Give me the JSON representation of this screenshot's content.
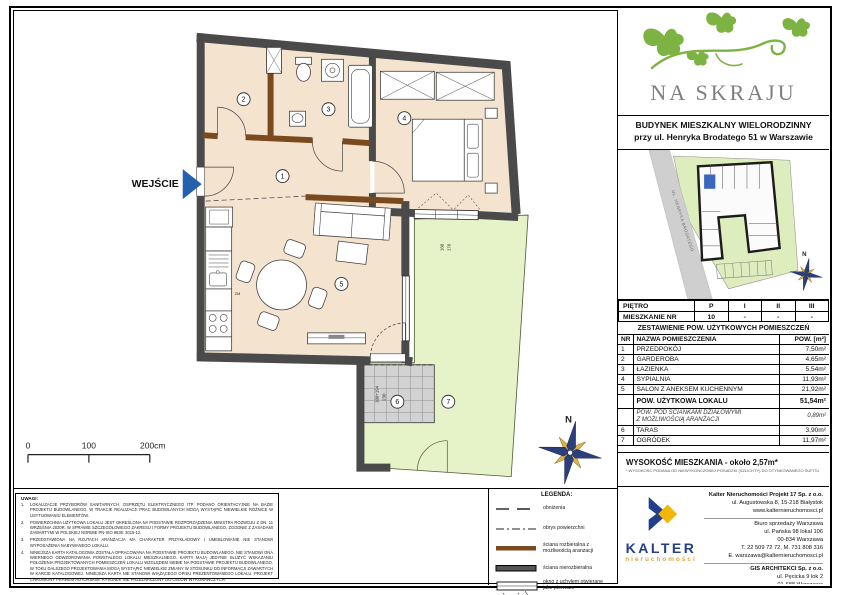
{
  "header": {
    "logo": "NA SKRAJU",
    "building_line1": "BUDYNEK MIESZKALNY WIELORODZINNY",
    "building_line2": "przy ul. Henryka Brodatego 51 w Warszawie"
  },
  "site_plan": {
    "street": "UL. HENRYKA BRODATEGO",
    "north": "N"
  },
  "floor_table": {
    "floor_label": "PIĘTRO",
    "floors": [
      "P",
      "I",
      "II",
      "III"
    ],
    "unit_label": "MIESZKANIE NR",
    "units": [
      "10",
      "-",
      "-",
      "-"
    ]
  },
  "area_table": {
    "title": "ZESTAWIENIE POW. UŻYTKOWYCH POMIESZCZEŃ",
    "col_nr": "NR",
    "col_name": "NAZWA POMIESZCZENIA",
    "col_area": "POW. [m²]",
    "rows": [
      {
        "nr": "1",
        "name": "PRZEDPOKÓJ",
        "area": "7,50m²"
      },
      {
        "nr": "2",
        "name": "GARDEROBA",
        "area": "4,65m²"
      },
      {
        "nr": "3",
        "name": "ŁAZIENKA",
        "area": "5,54m²"
      },
      {
        "nr": "4",
        "name": "SYPIALNIA",
        "area": "11,93m²"
      },
      {
        "nr": "5",
        "name": "SALON Z ANEKSEM KUCHENNYM",
        "area": "21,92m²"
      }
    ],
    "total_label": "POW. UŻYTKOWA LOKALU",
    "total_area": "51,54m²",
    "partition_line1": "POW. POD ŚCIANKAMI DZIAŁOWYMI",
    "partition_line2": "Z MOŻLIWOŚCIĄ ARANŻACJI",
    "partition_area": "0,89m²",
    "outdoor_rows": [
      {
        "nr": "6",
        "name": "TARAS",
        "area": "3,90m²"
      },
      {
        "nr": "7",
        "name": "OGRÓDEK",
        "area": "11,97m²"
      }
    ],
    "height_label": "WYSOKOŚĆ MIESZKANIA - około 2,57m*",
    "height_note": "* WYSOKOŚĆ PODANA OD NIEWYKOŃCZONEJ POSADZKI (SZLICHTY) DO OTYNKOWANEGO SUFITU"
  },
  "plan": {
    "entrance_label": "WEJŚCIE",
    "room_numbers": [
      "1",
      "2",
      "3",
      "4",
      "5",
      "6",
      "7"
    ],
    "kitchen_label": "ZM",
    "north": "N",
    "scale_ticks": [
      "0",
      "100",
      "200cm"
    ],
    "dims": {
      "terrace_w": "108+194",
      "terrace_h": "230",
      "window_a": "160",
      "window_b": "170"
    }
  },
  "legend": {
    "title": "LEGENDA:",
    "items": [
      "obniżenia",
      "obrys powierzchni",
      "ściana rozbieralna z możliwością aranżacji",
      "ściana nierozbieralna",
      "okno z uchyłem otwierane jako pierwsze"
    ]
  },
  "notes": {
    "title": "UWAGI:",
    "items": [
      {
        "num": "1.",
        "text": "LOKALIZACJE PRZYBORÓW SANITARNYCH, OSPRZĘTU ELEKTRYCZNEGO ITP. PODANO ORIENTACYJNIE NA BAZIE PROJEKTU BUDOWLANEGO. W TRAKCIE REALIZACJI PRAC BUDOWLANYCH MOGĄ WYSTĄPIĆ NIEWIELKIE RÓŻNICE W USYTUOWANIU ELEMENTÓW."
      },
      {
        "num": "2.",
        "text": "POWIERZCHNIA UŻYTKOWA LOKALU JEST OKREŚLONA NA PODSTAWIE ROZPORZĄDZENIA MINISTRA ROZWOJU Z DN. 11 WRZEŚNIA 2020R. W SPRAWIE SZCZEGÓŁOWEGO ZAKRESU I FORMY PROJEKTU BUDOWLANEGO, ZGODNIE Z ZASADAMI ZAWARTYMI W POLSKIEJ NORMIE PN-ISO 9836: 2015-12."
      },
      {
        "num": "3.",
        "text": "PRZEDSTAWIONA NA RZUTACH ARANŻACJA MA CHARAKTER PRZYKŁADOWY I UMEBLOWANIE NIE STANOWI WYPOSAŻENIA NABYWANEGO LOKALU."
      },
      {
        "num": "4.",
        "text": "NINIEJSZA KARTA KATALOGOWA ZOSTAŁA OPRACOWANA NA PODSTAWIE PROJEKTU BUDOWLANEGO. NIE STANOWI ONA WIERNEGO ODWZOROWANIA POWSTAŁEGO LOKALU MIESZKALNEGO. KARTY MAJĄ JEDYNIE SŁUŻYĆ WSKAZANIU POŁOŻENIA PROJEKTOWANYCH POMIESZCZEŃ LOKALU WZGLĘDEM SIEBIE NA PODSTAWIE PROJEKTU BUDOWLANEGO. W TOKU DALSZEGO PROJEKTOWANIA MOGĄ WYSTĄPIĆ NIEWIELKIE ZMIANY W STOSUNKU DO INFORMACJI ZAWARTYCH W KARCIE KATALOGOWEJ. NINIEJSZA KARTA NIE STANOWI WIĄŻĄCEGO OPISU PREZENTOWANEGO LOKALU. PROJEKT CHRONIONY PRAWEM AUTORSKIM. RYSUNEK NIE PRZEZNACZONY DO CELÓW WYKONAWCZYCH."
      }
    ]
  },
  "footer": {
    "brand": "KALTER",
    "brand_sub": "nieruchomości",
    "company": "Kalter Nieruchomości Projekt 17 Sp. z o.o.",
    "company_addr": "ul. Augustowska 8, 15-218 Białystok",
    "company_web": "www.kalternieruchomosci.pl",
    "office": "Biuro sprzedaży Warszawa",
    "office_addr1": "ul. Pańska 98 lokal 106",
    "office_addr2": "00-834 Warszawa",
    "office_phone": "T. 22 509 72 72, M. 731 808 316",
    "office_email": "E. warszawa@kalternieruchomosci.pl",
    "architect": "GIS ARCHITEKCI Sp. z o.o.",
    "architect_addr1": "ul. Pęcicka 9 lok 2",
    "architect_addr2": "01-688 Warszawa",
    "architect_web": "www.gisarchitekci.pl"
  },
  "colors": {
    "wall": "#4a4a4a",
    "demountable_wall": "#7a4a1e",
    "floor_fill": "#f4e3cf",
    "garden_fill": "#e6f2c8",
    "terrace_fill": "#d2d2d2",
    "entrance_arrow": "#2361ae",
    "logo_green": "#7cb342",
    "kalter_blue": "#233e8c",
    "kalter_yellow": "#f2b705"
  }
}
